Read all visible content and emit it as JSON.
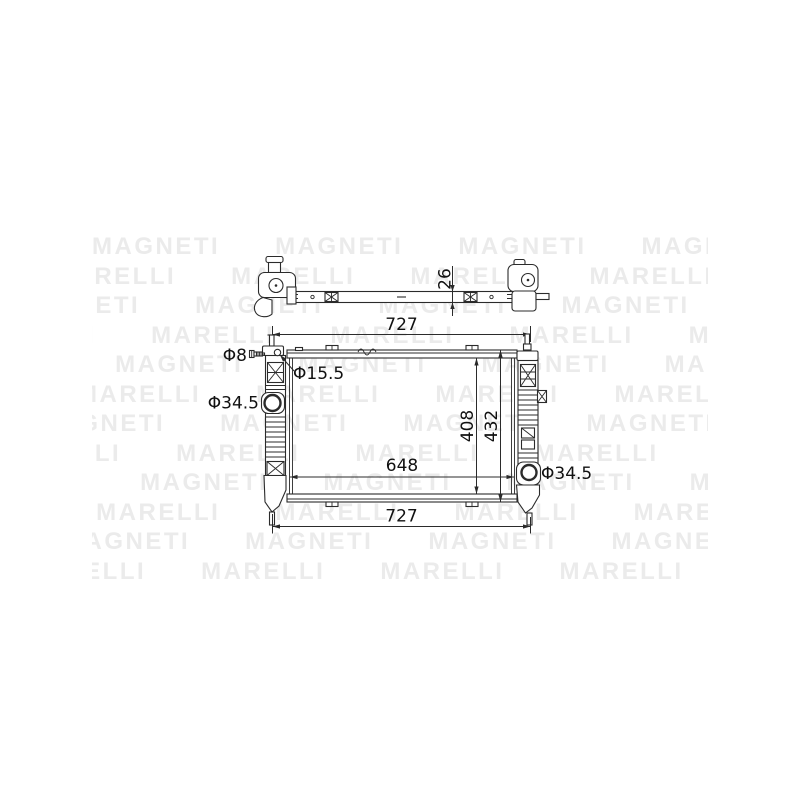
{
  "watermark": {
    "rows": [
      "MAGNETI      MAGNETI      MAGNETI      MAGNETI      MAGNETI",
      "MARELLI      MARELLI      MARELLI      MARELLI      MARELLI",
      "MAGNETI      MAGNETI      MAGNETI      MAGNETI      MAGNETI",
      "MARELLI      MARELLI      MARELLI      MARELLI      MARELLI",
      "MAGNETI      MAGNETI      MAGNETI      MAGNETI      MAGNETI",
      "MARELLI      MARELLI      MARELLI      MARELLI      MARELLI",
      "MAGNETI      MAGNETI      MAGNETI      MAGNETI      MAGNETI",
      "MARELLI      MARELLI      MARELLI      MARELLI      MARELLI",
      "MAGNETI      MAGNETI      MAGNETI      MAGNETI      MAGNETI",
      "MARELLI      MARELLI      MARELLI      MARELLI      MARELLI",
      "MAGNETI      MAGNETI      MAGNETI      MAGNETI      MAGNETI",
      "MARELLI      MARELLI      MARELLI      MARELLI      MARELLI"
    ]
  },
  "diagram": {
    "dims": {
      "top_thickness": "26",
      "width_top": "727",
      "bolt": "Φ8",
      "filler_hole": "Φ15.5",
      "inlet": "Φ34.5",
      "core_height": "408",
      "overall_height": "432",
      "core_width": "648",
      "width_bottom": "727",
      "outlet": "Φ34.5"
    },
    "colors": {
      "line": "#2b2b2b",
      "text": "#111111",
      "watermark": "#ebebeb",
      "background": "#ffffff"
    }
  }
}
